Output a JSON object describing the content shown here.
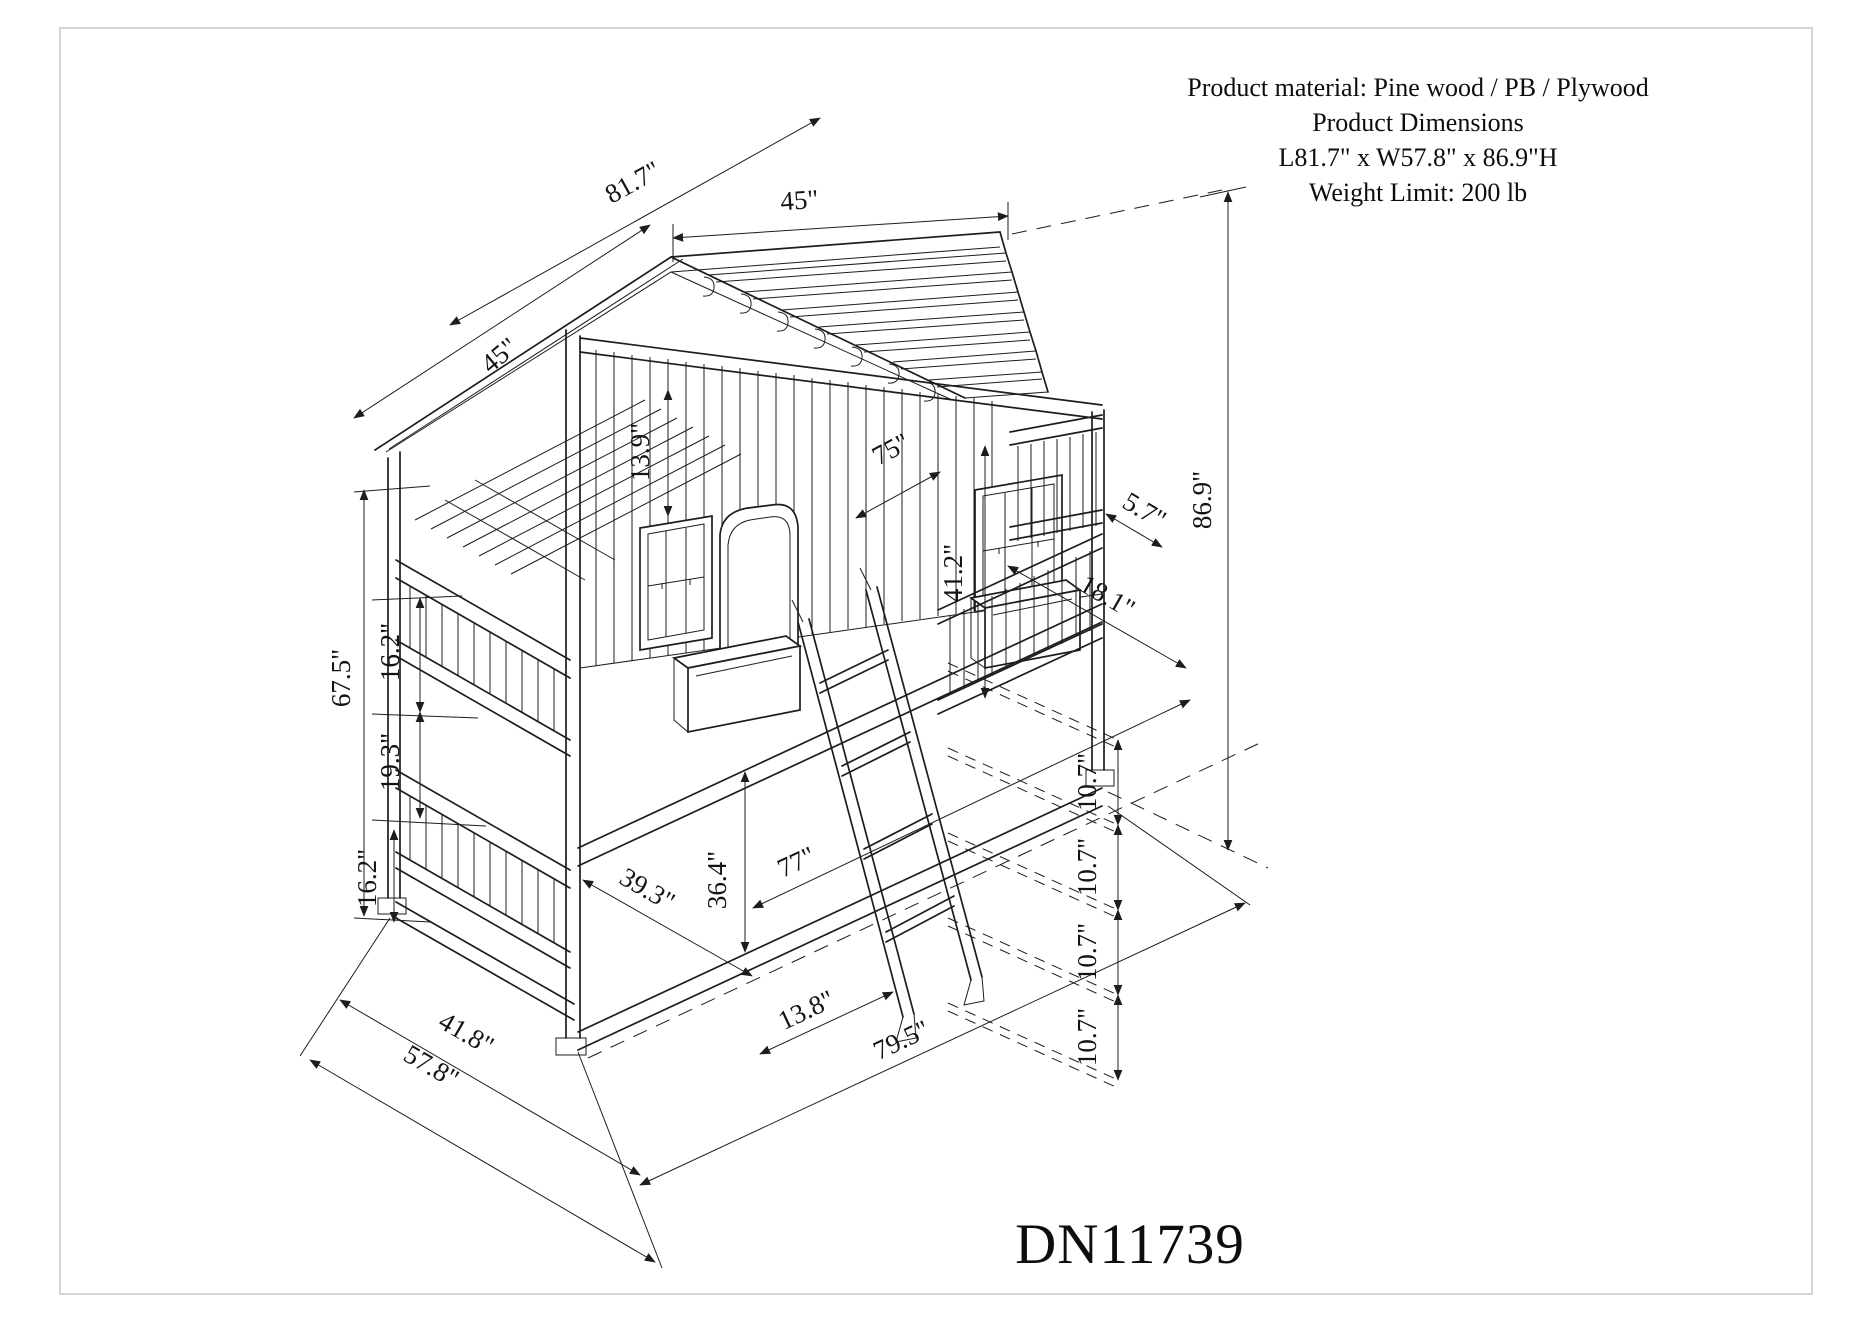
{
  "sheet": {
    "border_color": "#c6c6c6",
    "line_color": "#1d1d1d",
    "product_code": "DN11739"
  },
  "info": {
    "lines": [
      "Product material: Pine wood / PB / Plywood",
      "Product Dimensions",
      "L81.7\" x W57.8\" x 86.9\"H",
      "Weight Limit: 200 lb"
    ]
  },
  "dims": [
    {
      "name": "roof-length",
      "label": "81.7\""
    },
    {
      "name": "roof-top-width",
      "label": "45\""
    },
    {
      "name": "roof-slope-width",
      "label": "45\""
    },
    {
      "name": "roof-peak-height",
      "label": "13.9\""
    },
    {
      "name": "mattress-length",
      "label": "75\""
    },
    {
      "name": "wall-opening-height",
      "label": "41.2\""
    },
    {
      "name": "planter-height",
      "label": "5.7\""
    },
    {
      "name": "planter-length",
      "label": "18.1\""
    },
    {
      "name": "overall-height",
      "label": "86.9\""
    },
    {
      "name": "side-height",
      "label": "67.5\""
    },
    {
      "name": "upper-rail-gap",
      "label": "16.2\""
    },
    {
      "name": "mid-rail-gap",
      "label": "19.3\""
    },
    {
      "name": "lower-rail-gap",
      "label": "16.2\""
    },
    {
      "name": "bed-inner-width",
      "label": "39.3\""
    },
    {
      "name": "under-bed-height",
      "label": "36.4\""
    },
    {
      "name": "bed-inner-length",
      "label": "77\""
    },
    {
      "name": "bed-width",
      "label": "41.8\""
    },
    {
      "name": "overall-width",
      "label": "57.8\""
    },
    {
      "name": "ladder-offset",
      "label": "13.8\""
    },
    {
      "name": "overall-length",
      "label": "79.5\""
    },
    {
      "name": "rung-spacing-1",
      "label": "10.7\""
    },
    {
      "name": "rung-spacing-2",
      "label": "10.7\""
    },
    {
      "name": "rung-spacing-3",
      "label": "10.7\""
    },
    {
      "name": "rung-spacing-4",
      "label": "10.7\""
    }
  ]
}
